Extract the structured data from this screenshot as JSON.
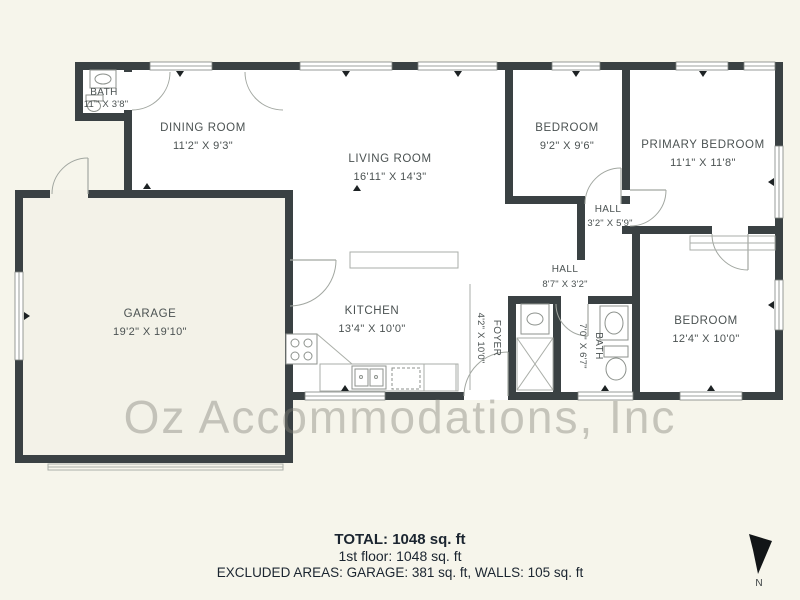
{
  "watermark": "Oz Accommodations, Inc",
  "compass": {
    "label": "N"
  },
  "rooms": [
    {
      "id": "bath-1",
      "name": "BATH",
      "dims": "11'\" X 3'8\""
    },
    {
      "id": "dining-room",
      "name": "DINING ROOM",
      "dims": "11'2\" X 9'3\""
    },
    {
      "id": "living-room",
      "name": "LIVING ROOM",
      "dims": "16'11\" X 14'3\""
    },
    {
      "id": "bedroom-top",
      "name": "BEDROOM",
      "dims": "9'2\" X 9'6\""
    },
    {
      "id": "primary-bedroom",
      "name": "PRIMARY BEDROOM",
      "dims": "11'1\" X 11'8\""
    },
    {
      "id": "hall-small",
      "name": "HALL",
      "dims": "3'2\" X 5'9\""
    },
    {
      "id": "hall",
      "name": "HALL",
      "dims": "8'7\" X 3'2\""
    },
    {
      "id": "kitchen",
      "name": "KITCHEN",
      "dims": "13'4\" X 10'0\""
    },
    {
      "id": "foyer",
      "name": "FOYER",
      "dims": "4'2\" X 10'0\""
    },
    {
      "id": "bath-2",
      "name": "BATH",
      "dims": "7'0\" X 6'7\""
    },
    {
      "id": "bedroom-right",
      "name": "BEDROOM",
      "dims": "12'4\" X 10'0\""
    },
    {
      "id": "garage",
      "name": "GARAGE",
      "dims": "19'2\" X 19'10\""
    }
  ],
  "footer": {
    "total": "TOTAL: 1048 sq. ft",
    "floor": "1st floor: 1048 sq. ft",
    "excluded": "EXCLUDED AREAS: GARAGE: 381 sq. ft, WALLS: 105 sq. ft"
  },
  "colors": {
    "background": "#f6f5eb",
    "walls": "#3a4143",
    "room_fill": "#ffffff",
    "garage_fill": "#f3f2e8",
    "label_text": "#4b5252",
    "footer_text": "#1b2530",
    "watermark": "#b4b4ac"
  }
}
